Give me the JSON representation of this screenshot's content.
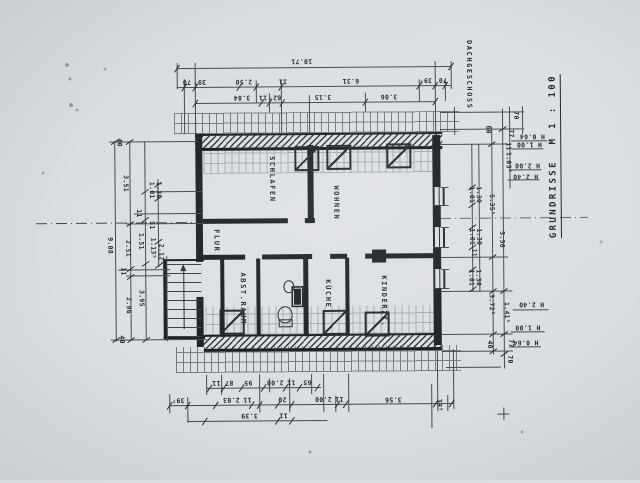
{
  "sheet": {
    "floor_label": "DACHGESCHOSS",
    "title": "GRUNDRISSE  M 1 : 100",
    "scale": "M 1 : 100",
    "paper_color": "#dcdfe2",
    "ink_color": "#24272c"
  },
  "rooms": [
    {
      "name": "SCHLAFEN",
      "x": 272,
      "y": 179
    },
    {
      "name": "WOHNEN",
      "x": 336,
      "y": 203
    },
    {
      "name": "FLUR",
      "x": 216,
      "y": 240
    },
    {
      "name": "ABST.RAUM",
      "x": 242,
      "y": 298
    },
    {
      "name": "KÜCHE",
      "x": 327,
      "y": 294
    },
    {
      "name": "KINDERZI.",
      "x": 383,
      "y": 302
    }
  ],
  "dimensions": {
    "top": [
      {
        "v": "10.71",
        "x": 303,
        "y": 61,
        "r": "flip"
      },
      {
        "v": "70",
        "x": 188,
        "y": 81,
        "r": "flip"
      },
      {
        "v": "39⁵",
        "x": 201,
        "y": 81,
        "r": "flip"
      },
      {
        "v": "2.50",
        "x": 245,
        "y": 81,
        "r": "flip"
      },
      {
        "v": "11",
        "x": 284,
        "y": 81,
        "r": "flip"
      },
      {
        "v": "6.31",
        "x": 352,
        "y": 81,
        "r": "flip"
      },
      {
        "v": "39⁵",
        "x": 427,
        "y": 81,
        "r": "flip"
      },
      {
        "v": "70",
        "x": 444,
        "y": 81,
        "r": "flip"
      },
      {
        "v": "3.84",
        "x": 243,
        "y": 97,
        "r": "flip"
      },
      {
        "v": "11",
        "x": 264,
        "y": 97,
        "r": "flip"
      },
      {
        "v": "62⁵",
        "x": 276,
        "y": 97,
        "r": "flip"
      },
      {
        "v": "3.15",
        "x": 324,
        "y": 97,
        "r": "flip"
      },
      {
        "v": "3.06",
        "x": 390,
        "y": 97,
        "r": "flip"
      }
    ],
    "bottom": [
      {
        "v": "11",
        "x": 215,
        "y": 382,
        "r": "flip"
      },
      {
        "v": "87",
        "x": 228,
        "y": 382,
        "r": "flip"
      },
      {
        "v": "95",
        "x": 247,
        "y": 382,
        "r": "flip"
      },
      {
        "v": "2.00",
        "x": 274,
        "y": 382,
        "r": "flip"
      },
      {
        "v": "11",
        "x": 290,
        "y": 382,
        "r": "flip"
      },
      {
        "v": "65",
        "x": 306,
        "y": 382,
        "r": "flip"
      },
      {
        "v": "39⁵",
        "x": 177,
        "y": 399,
        "r": "flip"
      },
      {
        "v": "2.03",
        "x": 230,
        "y": 399,
        "r": "flip"
      },
      {
        "v": "11",
        "x": 246,
        "y": 399,
        "r": "flip"
      },
      {
        "v": "20",
        "x": 281,
        "y": 399,
        "r": "flip"
      },
      {
        "v": "2.00",
        "x": 322,
        "y": 399,
        "r": "flip"
      },
      {
        "v": "11",
        "x": 338,
        "y": 399,
        "r": "flip"
      },
      {
        "v": "3.56",
        "x": 392,
        "y": 400,
        "r": "flip"
      },
      {
        "v": "3.39",
        "x": 248,
        "y": 415,
        "r": "flip"
      },
      {
        "v": "11",
        "x": 282,
        "y": 415,
        "r": "flip"
      },
      {
        "v": "39⁵",
        "x": 438,
        "y": 406,
        "r": "cw"
      }
    ],
    "left": [
      {
        "v": "40",
        "x": 120,
        "y": 141,
        "r": "cw"
      },
      {
        "v": "3.51",
        "x": 126,
        "y": 182,
        "r": "cw"
      },
      {
        "v": "1.01",
        "x": 152,
        "y": 189,
        "r": "cw"
      },
      {
        "v": "1.30",
        "x": 159,
        "y": 189,
        "r": "cw"
      },
      {
        "v": "11",
        "x": 139,
        "y": 212,
        "r": "cw"
      },
      {
        "v": "51",
        "x": 152,
        "y": 224,
        "r": "cw"
      },
      {
        "v": "9.08",
        "x": 110,
        "y": 244,
        "r": "cw"
      },
      {
        "v": "1.51",
        "x": 141,
        "y": 240,
        "r": "cw"
      },
      {
        "v": "2.51",
        "x": 128,
        "y": 247,
        "r": "cw"
      },
      {
        "v": "1.13⁵",
        "x": 153,
        "y": 247,
        "r": "cw"
      },
      {
        "v": "2.12⁵",
        "x": 161,
        "y": 253,
        "r": "cw"
      },
      {
        "v": "11",
        "x": 123,
        "y": 270,
        "r": "cw"
      },
      {
        "v": "3.95",
        "x": 141,
        "y": 297,
        "r": "cw"
      },
      {
        "v": "2.96",
        "x": 128,
        "y": 304,
        "r": "cw"
      },
      {
        "v": "40",
        "x": 121,
        "y": 338,
        "r": "cw"
      }
    ],
    "right": [
      {
        "v": "70",
        "x": 517,
        "y": 117,
        "r": "cw"
      },
      {
        "v": "60",
        "x": 489,
        "y": 131,
        "r": "cw"
      },
      {
        "v": "77",
        "x": 512,
        "y": 135,
        "r": "cw"
      },
      {
        "v": "11",
        "x": 509,
        "y": 148,
        "r": "cw"
      },
      {
        "v": "1.03⁵",
        "x": 509,
        "y": 164,
        "r": "cw"
      },
      {
        "v": "1.01",
        "x": 472,
        "y": 196,
        "r": "cw"
      },
      {
        "v": "1.30",
        "x": 479,
        "y": 196,
        "r": "cw"
      },
      {
        "v": "5.35⁵",
        "x": 492,
        "y": 206,
        "r": "cw"
      },
      {
        "v": "1.01",
        "x": 472,
        "y": 238,
        "r": "cw"
      },
      {
        "v": "1.30",
        "x": 479,
        "y": 238,
        "r": "cw"
      },
      {
        "v": "5.56",
        "x": 502,
        "y": 241,
        "r": "cw"
      },
      {
        "v": "11",
        "x": 474,
        "y": 254,
        "r": "cw"
      },
      {
        "v": "1.81",
        "x": 471,
        "y": 279,
        "r": "cw"
      },
      {
        "v": "1.30",
        "x": 478,
        "y": 279,
        "r": "cw"
      },
      {
        "v": "3.72⁵",
        "x": 491,
        "y": 306,
        "r": "cw"
      },
      {
        "v": "1.41⁵",
        "x": 506,
        "y": 314,
        "r": "cw"
      },
      {
        "v": "40",
        "x": 489,
        "y": 346,
        "r": "cw"
      },
      {
        "v": "77",
        "x": 510,
        "y": 345,
        "r": "cw"
      },
      {
        "v": "70",
        "x": 509,
        "y": 361,
        "r": "cw"
      }
    ],
    "heights": [
      {
        "v": "H 0.64",
        "x": 533,
        "y": 138,
        "r": "flip"
      },
      {
        "v": "H 1.00",
        "x": 530,
        "y": 146,
        "r": "flip"
      },
      {
        "v": "H 2.00",
        "x": 528,
        "y": 167,
        "r": "flip"
      },
      {
        "v": "H 2.40",
        "x": 526,
        "y": 178,
        "r": "flip"
      },
      {
        "v": "H 2.40",
        "x": 531,
        "y": 306,
        "r": "flip"
      },
      {
        "v": "H 1.00",
        "x": 527,
        "y": 329,
        "r": "flip"
      },
      {
        "v": "H 0.64",
        "x": 525,
        "y": 344,
        "r": "flip"
      }
    ]
  }
}
